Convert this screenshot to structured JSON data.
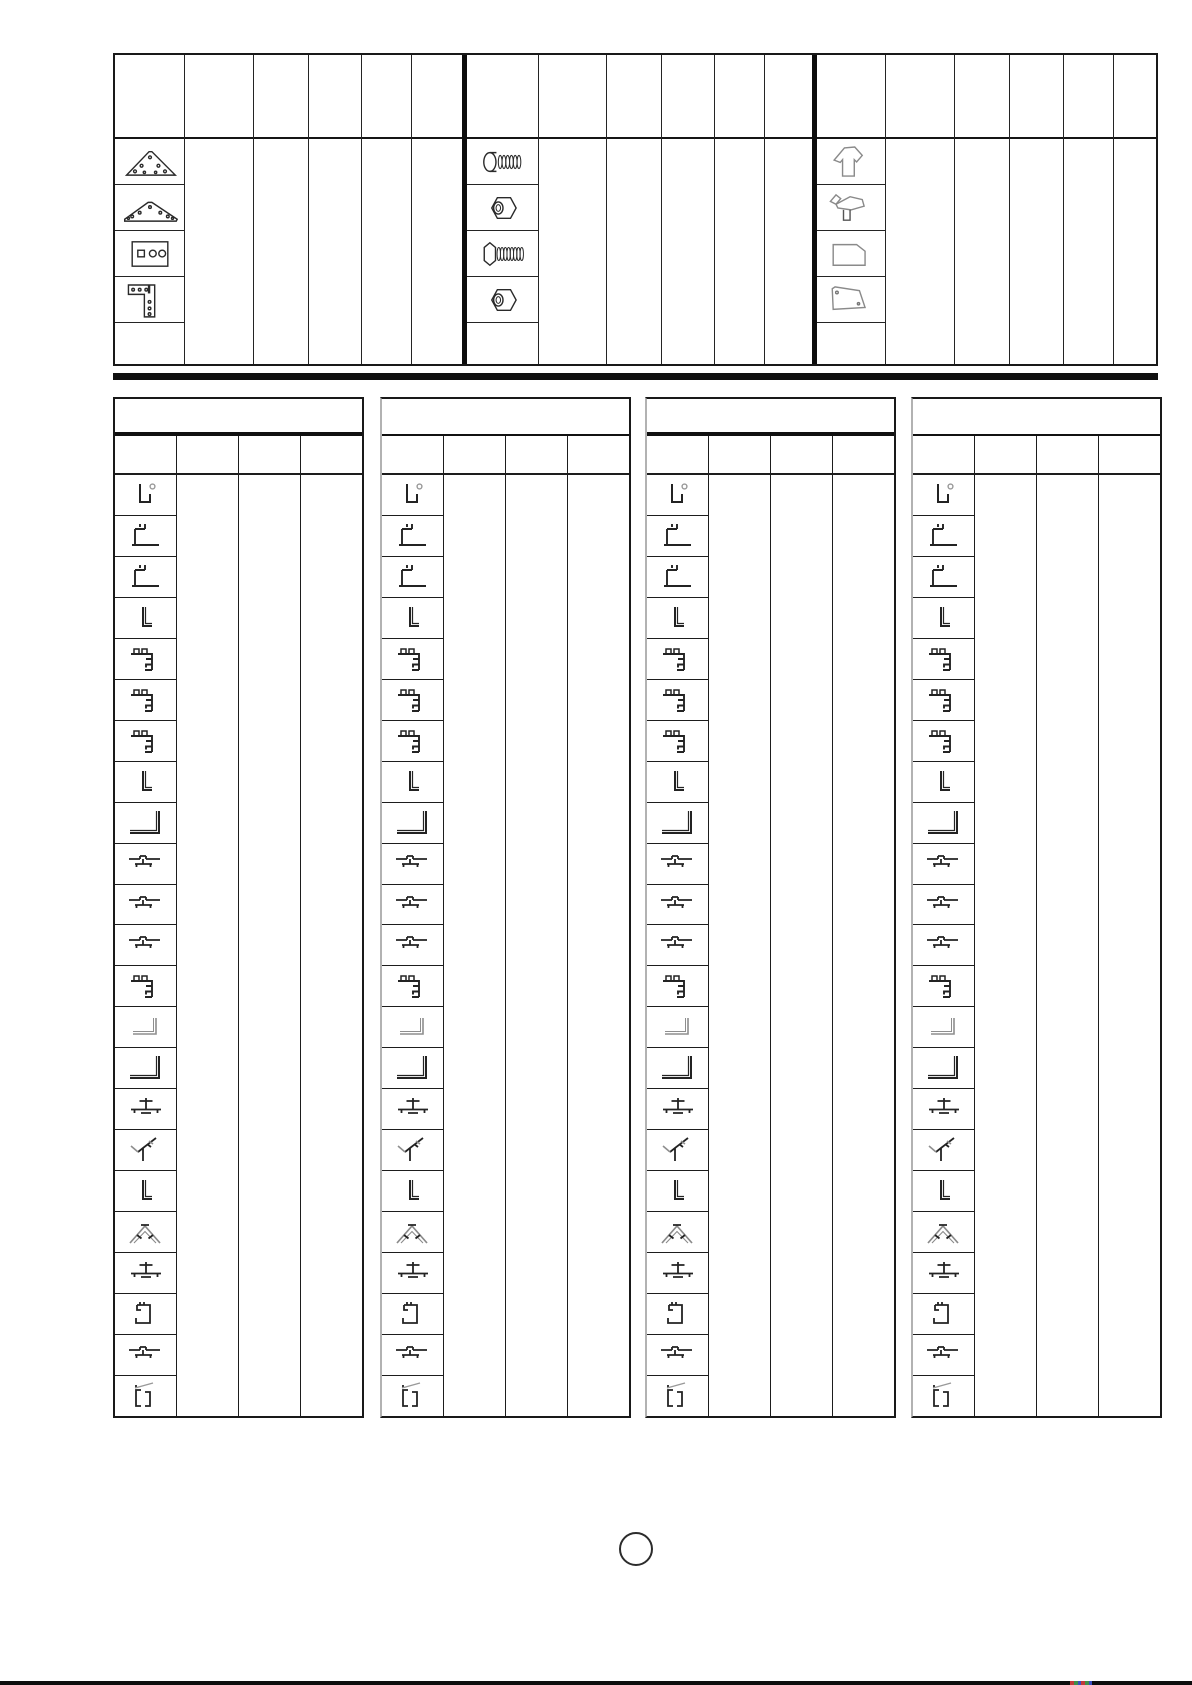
{
  "page": {
    "background_color": "#ffffff",
    "ink_color": "#1a1a1a",
    "accent_gray": "#8a8a8a",
    "separator_bar_color": "#101010",
    "page_number_text": ""
  },
  "top_table": {
    "title": "",
    "header_row_label": "",
    "sections": [
      {
        "name": "bracket-parts",
        "icon_rows": [
          "triangle-gusset-plate-icon",
          "wide-gusset-plate-icon",
          "rectangular-plate-icon",
          "l-shaped-plate-icon"
        ],
        "quantity_columns": 5,
        "cell_values": [
          "",
          "",
          "",
          "",
          ""
        ]
      },
      {
        "name": "fastener-parts",
        "icon_rows": [
          "pan-head-bolt-icon",
          "hex-nut-icon",
          "long-hex-bolt-icon",
          "hex-nut-icon"
        ],
        "quantity_columns": 5,
        "cell_values": [
          "",
          "",
          "",
          "",
          ""
        ]
      },
      {
        "name": "panel-parts",
        "icon_rows": [
          "gable-panel-icon",
          "corner-clip-panel-icon",
          "side-panel-icon",
          "sloped-panel-icon"
        ],
        "quantity_columns": 5,
        "cell_values": [
          "",
          "",
          "",
          "",
          ""
        ]
      }
    ]
  },
  "profile_tables": {
    "count": 4,
    "title_band_label": "",
    "subheader_labels": [
      "",
      "",
      "",
      ""
    ],
    "quantity_columns": 3,
    "row_icons": [
      "u-channel-profile-icon",
      "base-sill-profile-icon",
      "base-sill-profile-icon",
      "angle-profile-icon",
      "corner-post-profile-icon",
      "corner-post-profile-icon",
      "corner-post-profile-icon",
      "angle-profile-icon",
      "large-angle-profile-icon",
      "glazing-bar-profile-icon",
      "glazing-bar-profile-icon",
      "glazing-bar-profile-icon",
      "corner-post-profile-icon",
      "shallow-angle-profile-icon",
      "large-angle-profile-icon",
      "tee-profile-icon",
      "gutter-corner-profile-icon",
      "angle-profile-icon",
      "ridge-profile-icon",
      "tee-profile-icon",
      "channel-clip-profile-icon",
      "glazing-bar-profile-icon",
      "door-rail-profile-icon"
    ]
  }
}
